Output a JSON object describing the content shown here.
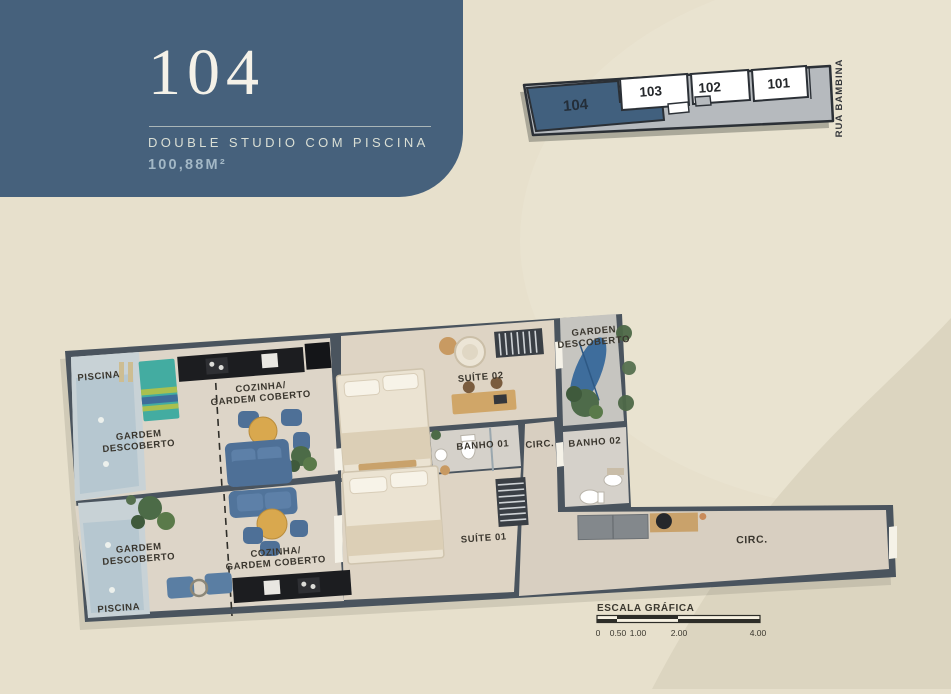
{
  "page": {
    "bg": "#e7e0cc",
    "bg_light": "#ebe5d3",
    "bg_dark": "#dcd5c0"
  },
  "header": {
    "unit_number": "104",
    "subtitle": "DOUBLE STUDIO COM PISCINA",
    "area": "100,88M²",
    "panel_color": "#46617c"
  },
  "keyplan": {
    "street_label": "RUA BAMBINA",
    "highlight_color": "#41607e",
    "units": [
      {
        "id": "104",
        "highlighted": true
      },
      {
        "id": "103",
        "highlighted": false
      },
      {
        "id": "102",
        "highlighted": false
      },
      {
        "id": "101",
        "highlighted": false
      }
    ]
  },
  "plan": {
    "wall_color": "#4a545e",
    "labels": {
      "piscina_top": "PISCINA",
      "gardem_top": [
        "GARDEM",
        "DESCOBERTO"
      ],
      "cozinha_top": [
        "COZINHA/",
        "GARDEM COBERTO"
      ],
      "suite02": "SUÍTE 02",
      "garden_right": [
        "GARDEN",
        "DESCOBERTO"
      ],
      "banho01": "BANHO 01",
      "circ_small": "CIRC.",
      "banho02": "BANHO 02",
      "suite01": "SUÍTE 01",
      "cozinha_bottom": [
        "COZINHA/",
        "GARDEM COBERTO"
      ],
      "gardem_bottom": [
        "GARDEM",
        "DESCOBERTO"
      ],
      "piscina_bottom": "PISCINA",
      "circ_corridor": "CIRC."
    }
  },
  "scalebar": {
    "title": "ESCALA GRÁFICA",
    "ticks": [
      "0",
      "0.50",
      "1.00",
      "2.00",
      "4.00"
    ]
  }
}
